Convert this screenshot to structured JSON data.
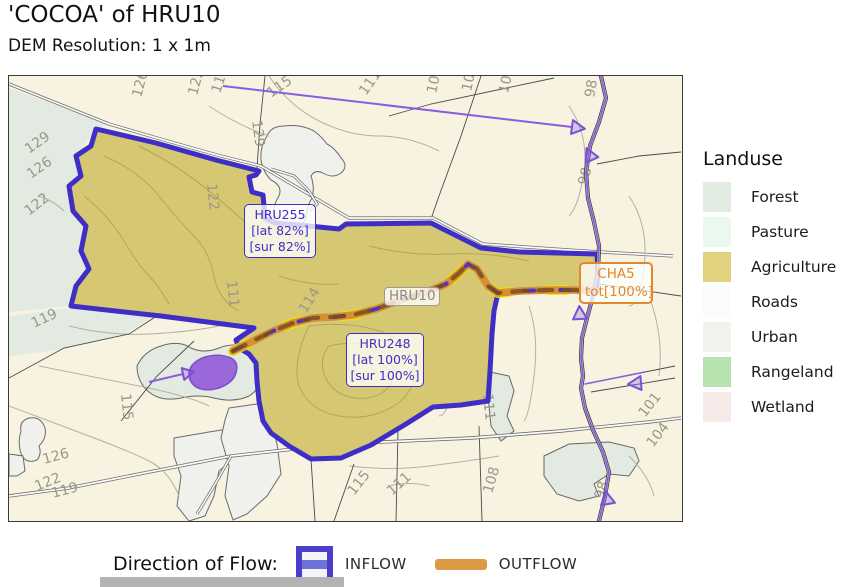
{
  "title": "'COCOA' of HRU10",
  "subtitle": "DEM Resolution: 1 x 1m",
  "landuse_legend": {
    "title": "Landuse",
    "items": [
      {
        "label": "Forest",
        "color": "#e3ece3"
      },
      {
        "label": "Pasture",
        "color": "#ebf8ef"
      },
      {
        "label": "Agriculture",
        "color": "#e0d27f"
      },
      {
        "label": "Roads",
        "color": "#fbfbfa"
      },
      {
        "label": "Urban",
        "color": "#f1f1ee"
      },
      {
        "label": "Rangeland",
        "color": "#b6e3ad"
      },
      {
        "label": "Wetland",
        "color": "#f9eaea"
      }
    ]
  },
  "flow_legend": {
    "label": "Direction of Flow:",
    "inflow_label": "INFLOW",
    "outflow_label": "OUTFLOW",
    "inflow_color": "#4a3fc9",
    "inflow_stripe_color": "#6c74d8",
    "outflow_color": "#dd9a44"
  },
  "map": {
    "annotations": {
      "hru255": {
        "title": "HRU255",
        "line2": "[lat 82%]",
        "line3": "[sur 82%]"
      },
      "hru248": {
        "title": "HRU248",
        "line2": "[lat 100%]",
        "line3": "[sur 100%]"
      },
      "hru10": {
        "title": "HRU10"
      },
      "cha5": {
        "title": "CHA5",
        "line2": "tot[100%]"
      }
    },
    "colors": {
      "background": "#f7f3e0",
      "boundary": "#3e2ec5",
      "agriculture_fill": "#d6c872",
      "stream_purple": "#8a5ce0",
      "outflow_orange": "#d78f35",
      "outflow_brown": "#7a4e1e",
      "outflow_yellow": "#f2e400",
      "pond_fill": "#9a68d8"
    },
    "contour_labels": [
      {
        "text": "129",
        "x": 20,
        "y": 78,
        "rot": -35
      },
      {
        "text": "126",
        "x": 22,
        "y": 103,
        "rot": -35
      },
      {
        "text": "122",
        "x": 20,
        "y": 140,
        "rot": -38
      },
      {
        "text": "126",
        "x": 132,
        "y": 22,
        "rot": -75
      },
      {
        "text": "122",
        "x": 188,
        "y": 20,
        "rot": -75
      },
      {
        "text": "119",
        "x": 211,
        "y": 18,
        "rot": -72
      },
      {
        "text": "129",
        "x": 243,
        "y": 45,
        "rot": 82
      },
      {
        "text": "115",
        "x": 262,
        "y": 22,
        "rot": -35
      },
      {
        "text": "111",
        "x": 357,
        "y": 20,
        "rot": -55
      },
      {
        "text": "108",
        "x": 427,
        "y": 18,
        "rot": -78
      },
      {
        "text": "104",
        "x": 462,
        "y": 16,
        "rot": -78
      },
      {
        "text": "101",
        "x": 499,
        "y": 18,
        "rot": -78
      },
      {
        "text": "98",
        "x": 585,
        "y": 22,
        "rot": -80
      },
      {
        "text": "98",
        "x": 578,
        "y": 110,
        "rot": -75
      },
      {
        "text": "122",
        "x": 198,
        "y": 108,
        "rot": 84
      },
      {
        "text": "111",
        "x": 218,
        "y": 205,
        "rot": 84
      },
      {
        "text": "114",
        "x": 297,
        "y": 238,
        "rot": -58
      },
      {
        "text": "115",
        "x": 112,
        "y": 318,
        "rot": 84
      },
      {
        "text": "119",
        "x": 25,
        "y": 252,
        "rot": -25
      },
      {
        "text": "126",
        "x": 35,
        "y": 388,
        "rot": -15
      },
      {
        "text": "122",
        "x": 28,
        "y": 415,
        "rot": -22
      },
      {
        "text": "119",
        "x": 44,
        "y": 422,
        "rot": -15
      },
      {
        "text": "115",
        "x": 345,
        "y": 420,
        "rot": -52
      },
      {
        "text": "111",
        "x": 383,
        "y": 420,
        "rot": -42
      },
      {
        "text": "108",
        "x": 483,
        "y": 418,
        "rot": -74
      },
      {
        "text": "111",
        "x": 474,
        "y": 318,
        "rot": 84
      },
      {
        "text": "101",
        "x": 636,
        "y": 342,
        "rot": -52
      },
      {
        "text": "104",
        "x": 644,
        "y": 372,
        "rot": -52
      },
      {
        "text": "98",
        "x": 594,
        "y": 424,
        "rot": -72
      }
    ]
  }
}
